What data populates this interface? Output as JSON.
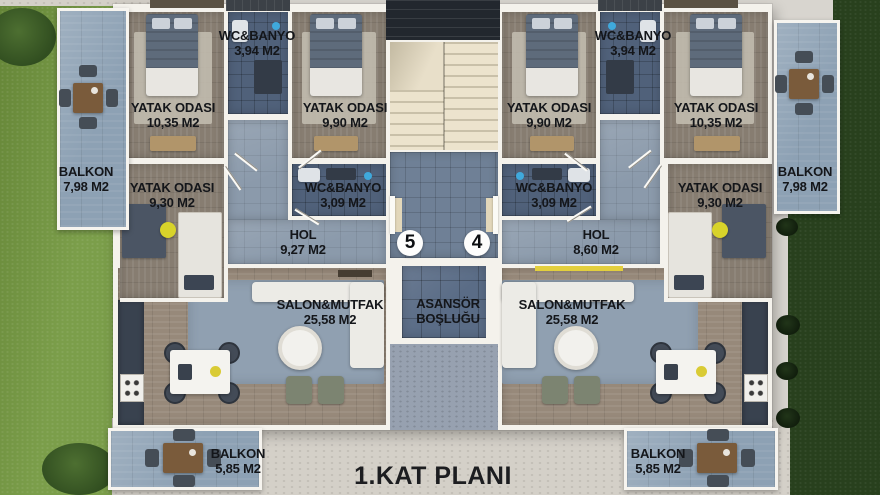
{
  "title": "1.KAT PLANI",
  "unit_numbers": {
    "left": "5",
    "right": "4"
  },
  "elevator": {
    "line1": "ASANSÖR",
    "line2": "BOŞLUĞU"
  },
  "labels": {
    "l_bed1": {
      "name": "YATAK ODASI",
      "area": "10,35 M2"
    },
    "l_wc1": {
      "name": "WC&BANYO",
      "area": "3,94 M2"
    },
    "l_bed2": {
      "name": "YATAK ODASI",
      "area": "9,90 M2"
    },
    "l_bed3": {
      "name": "YATAK ODASI",
      "area": "9,30 M2"
    },
    "l_wc2": {
      "name": "WC&BANYO",
      "area": "3,09 M2"
    },
    "l_hol": {
      "name": "HOL",
      "area": "9,27 M2"
    },
    "l_salon": {
      "name": "SALON&MUTFAK",
      "area": "25,58 M2"
    },
    "l_balkon": {
      "name": "BALKON",
      "area": "7,98 M2"
    },
    "l_balkon_alt": {
      "name": "BALKON",
      "area": "5,85 M2"
    },
    "r_bed1": {
      "name": "YATAK ODASI",
      "area": "9,90 M2"
    },
    "r_wc1": {
      "name": "WC&BANYO",
      "area": "3,94 M2"
    },
    "r_bed2": {
      "name": "YATAK ODASI",
      "area": "10,35 M2"
    },
    "r_wc2": {
      "name": "WC&BANYO",
      "area": "3,09 M2"
    },
    "r_bed3": {
      "name": "YATAK ODASI",
      "area": "9,30 M2"
    },
    "r_hol": {
      "name": "HOL",
      "area": "8,60 M2"
    },
    "r_salon": {
      "name": "SALON&MUTFAK",
      "area": "25,58 M2"
    },
    "r_balkon": {
      "name": "BALKON",
      "area": "7,98 M2"
    },
    "r_balkon_alt": {
      "name": "BALKON",
      "area": "5,85 M2"
    }
  },
  "palette": {
    "label_text": "#14161a",
    "accent_yellow": "#d8d32a",
    "grass_light": "#73983f",
    "grass_dark": "#28401d",
    "wall_white": "#f4f2ec",
    "tile_dark": "#50617a",
    "balcony_tile": "#8da1b4"
  }
}
